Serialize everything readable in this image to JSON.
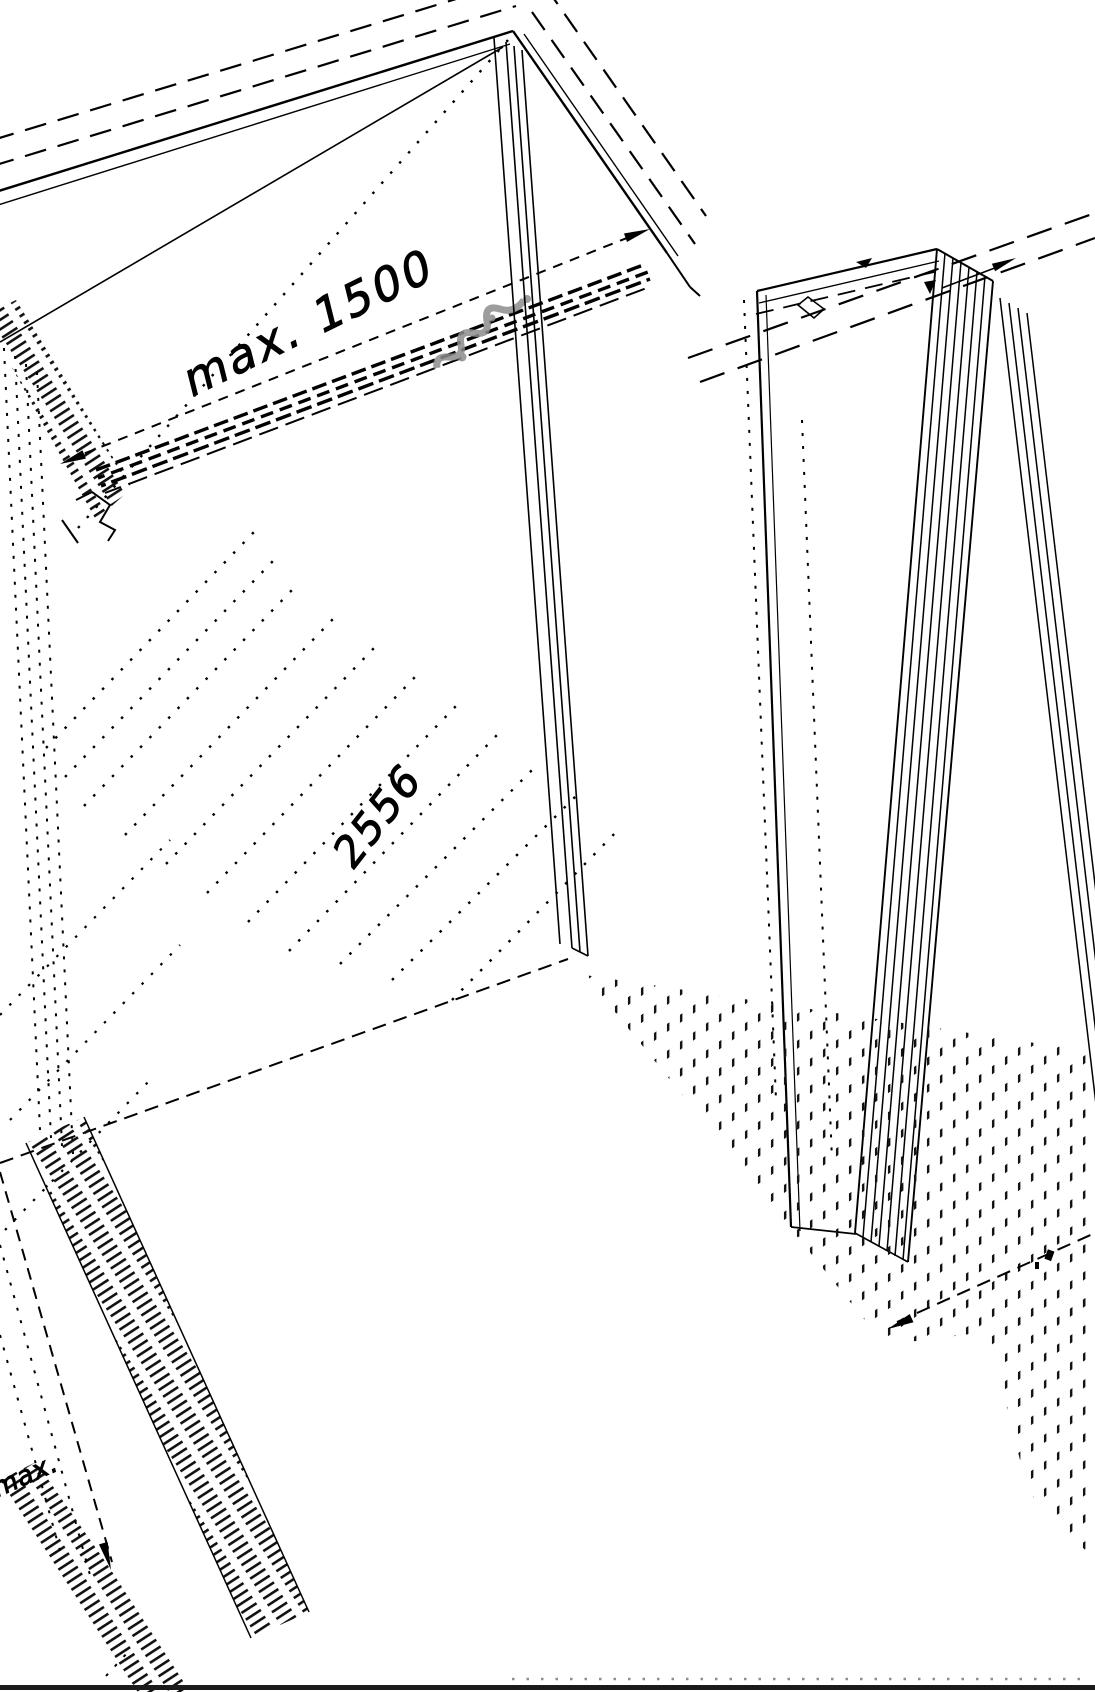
{
  "page": {
    "background": "#ffffff"
  },
  "drawing": {
    "labels": {
      "dim_max_1500": "max. 1500",
      "dim_panel": "2556",
      "dim_partial_bottom_left": "max."
    },
    "colors": {
      "line": "#000000",
      "watermark_gray": "#8c8c8c",
      "dotted_row_gray": "#8e8e8e",
      "bottom_bar": "#1b1b1b"
    }
  }
}
